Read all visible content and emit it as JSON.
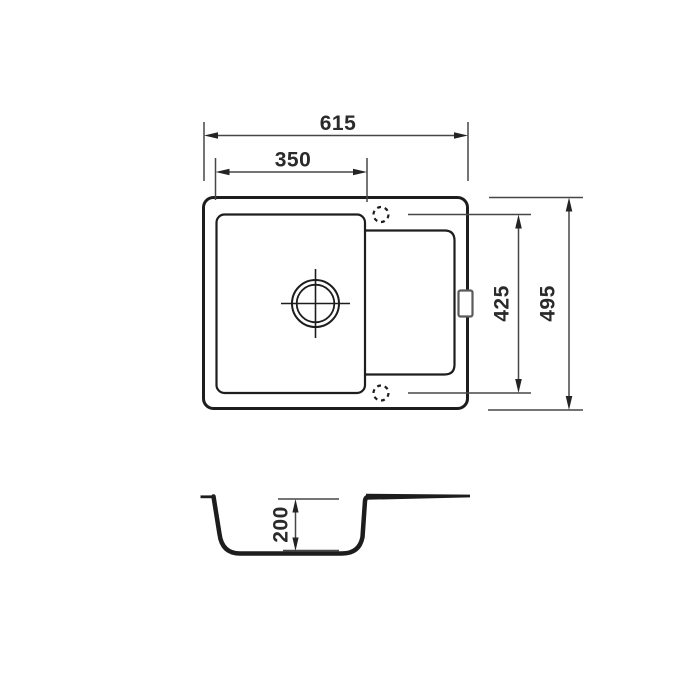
{
  "diagram": {
    "kind": "technical-drawing",
    "subject": "kitchen sink with bowl and drainboard, dimensioned top view and section view",
    "colors": {
      "background": "#ffffff",
      "object_line": "#1d1d1d",
      "dimension_line": "#474747",
      "text": "#2a2a2a",
      "clip_outline": "#5a5a5a"
    },
    "views": {
      "top_view": {
        "overall_width": "615",
        "bowl_width": "350",
        "holes_span": "425",
        "overall_depth": "495"
      },
      "section_view": {
        "bowl_depth": "200"
      }
    }
  }
}
